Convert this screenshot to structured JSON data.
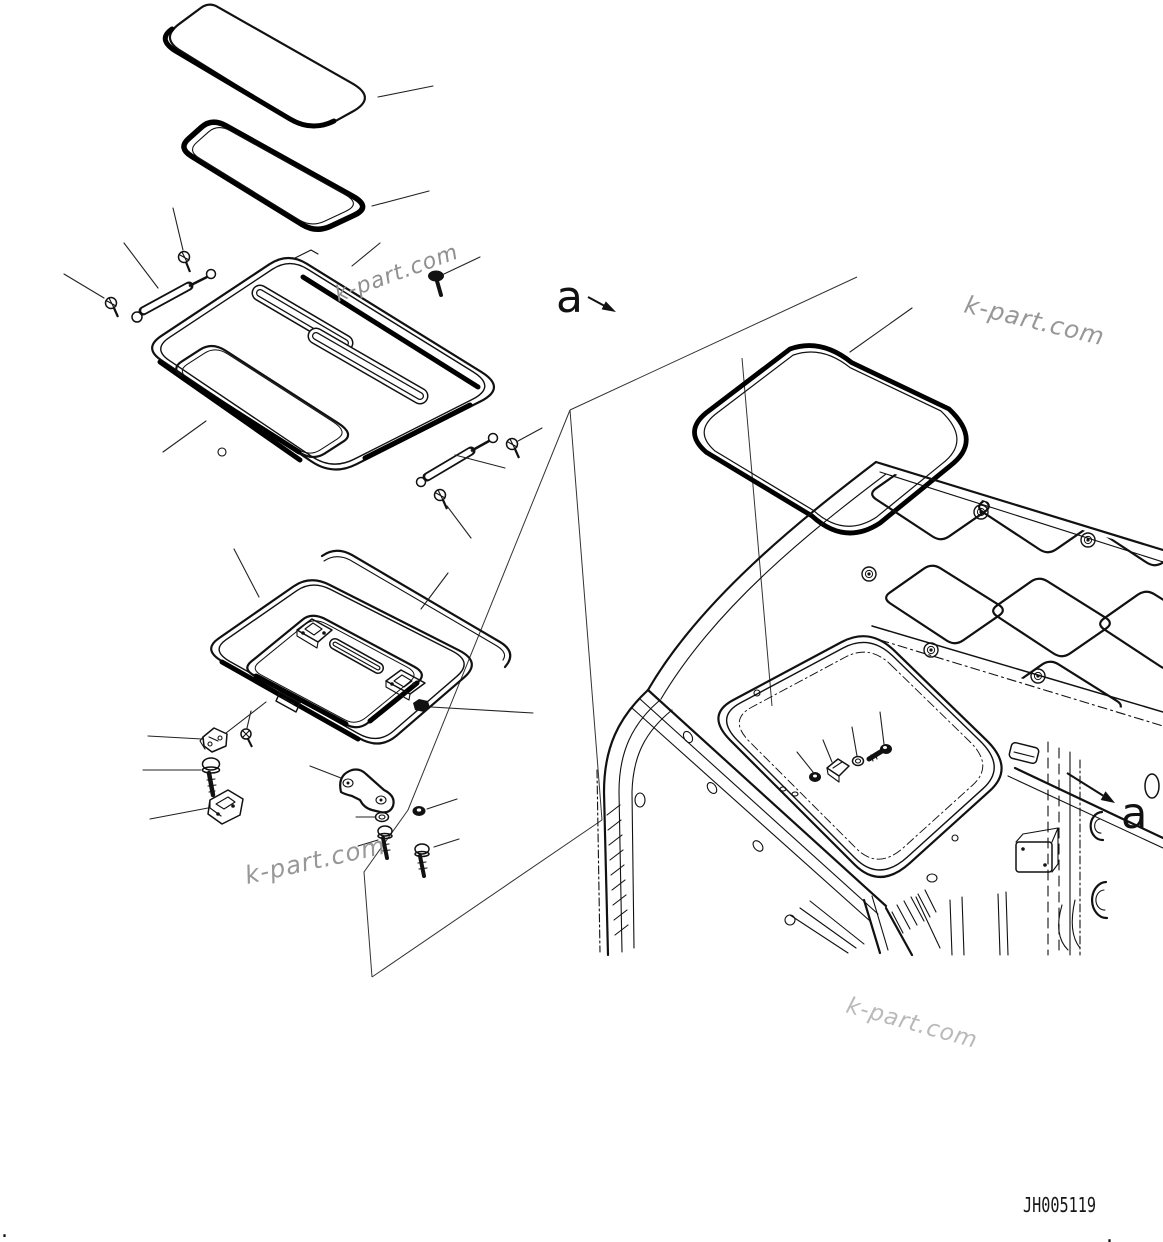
{
  "page": {
    "background": "#ffffff",
    "line_color": "#111111",
    "watermark_color": "#989898"
  },
  "drawing": {
    "number": "JH005119"
  },
  "annotations": {
    "section_label_left": "a",
    "section_label_right": "a"
  },
  "watermarks": [
    "k-part.com",
    "k-part.com",
    "k-part.com",
    "k-part.com"
  ],
  "marks": {
    "dot_left": ".",
    "dot_right": "."
  }
}
